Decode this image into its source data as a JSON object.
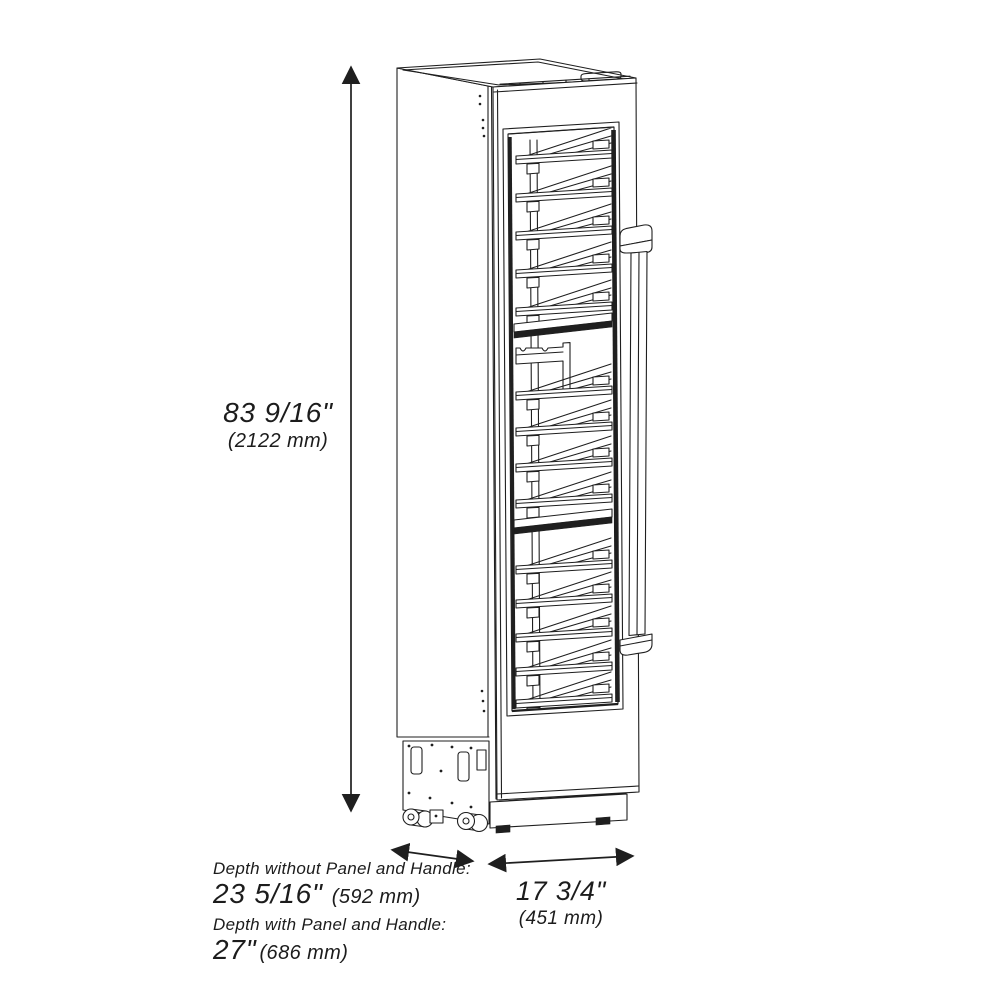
{
  "page": {
    "background": "#ffffff",
    "line_color": "#1f1f1f"
  },
  "drawing": {
    "subject": "tall single-door wine cooler, perspective line drawing with glass door, slide-out bottle racks, vertical bar handle, compressor base with casters"
  },
  "labels": {
    "height": {
      "value": "83 9/16\"",
      "metric": "(2122 mm)"
    },
    "depth_without": {
      "caption": "Depth without Panel and Handle:",
      "value": "23 5/16\"",
      "metric": "(592 mm)"
    },
    "depth_with": {
      "caption": "Depth with Panel and Handle:",
      "value": "27\"",
      "metric": "(686 mm)"
    },
    "width": {
      "value": "17 3/4\"",
      "metric": "(451 mm)"
    }
  }
}
